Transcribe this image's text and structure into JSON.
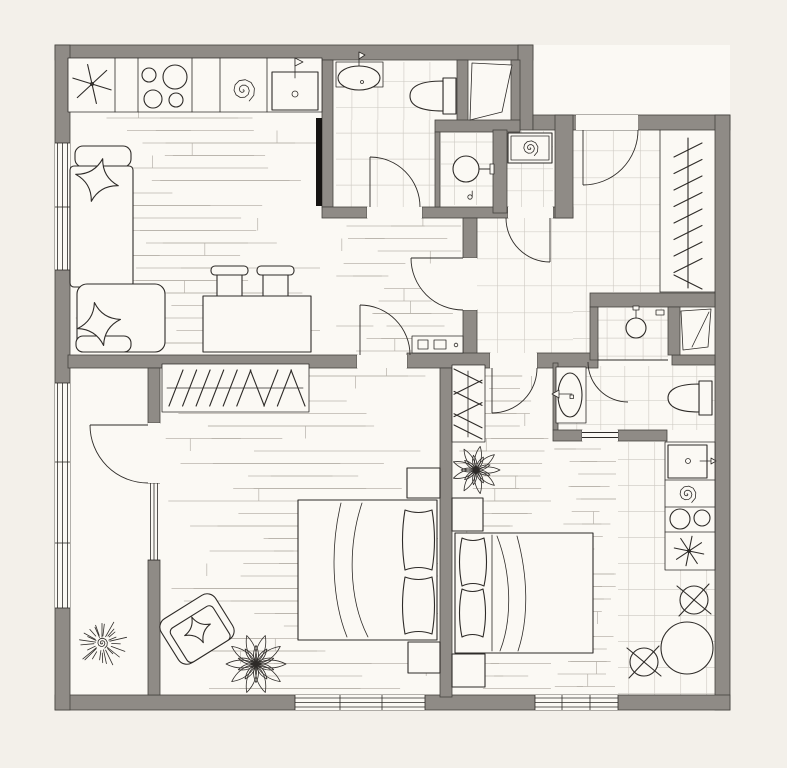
{
  "drawing": {
    "type": "apartment-floor-plan",
    "style": "hand-drawn architectural top view, no text labels"
  },
  "colors": {
    "bg": "#f3f0ea",
    "floor": "#fbf9f4",
    "wall": "#8f8b86",
    "wallEdge": "#44413e",
    "line": "#2e2b28",
    "tile": "#cdc9c2",
    "plank": "#b4afa7",
    "black": "#161412"
  },
  "rooms": [
    {
      "name": "living-room-with-kitchen",
      "fixtures": [
        "kitchen-counter",
        "extractor-star",
        "cooktop-4-burners",
        "spiral-appliance",
        "kitchen-sink-with-tap",
        "tall-black-unit",
        "corner-sofa",
        "two-star-pillows",
        "dining-table",
        "two-stools",
        "low-console"
      ]
    },
    {
      "name": "bathroom-top",
      "fixtures": [
        "vanity-sink",
        "toilet",
        "swing-door"
      ]
    },
    {
      "name": "water-closet",
      "fixtures": [
        "wall-basin-with-rail"
      ]
    },
    {
      "name": "utility-closet",
      "fixtures": [
        "washing-machine",
        "swing-door"
      ]
    },
    {
      "name": "entry-hall",
      "fixtures": [
        "entrance-door",
        "open-wardrobe-with-hangers",
        "tiled-floor"
      ]
    },
    {
      "name": "built-in-closet-top",
      "fixtures": [
        "trapezoid-wardrobe"
      ]
    },
    {
      "name": "shower-room",
      "fixtures": [
        "shower-head",
        "soap-shelf",
        "swing-door"
      ]
    },
    {
      "name": "built-in-closet-middle",
      "fixtures": [
        "trapezoid-wardrobe"
      ]
    },
    {
      "name": "bathroom-bottom",
      "fixtures": [
        "vanity-sink",
        "toilet",
        "doorway"
      ]
    },
    {
      "name": "bedroom",
      "fixtures": [
        "wardrobe-with-hangers",
        "double-bed",
        "two-pillows",
        "two-nightstands",
        "armchair-with-pillow",
        "plant"
      ]
    },
    {
      "name": "studio-room",
      "fixtures": [
        "wardrobe-with-hangers",
        "plant",
        "double-bed",
        "two-pillows",
        "two-nightstands",
        "kitchenette-counter",
        "sink-with-tap",
        "spiral-appliance",
        "cooktop-2-burners",
        "extractor-star",
        "round-table",
        "two-chairs"
      ]
    },
    {
      "name": "balcony",
      "fixtures": [
        "spiky-plant",
        "glazed-wall",
        "balcony-door"
      ]
    }
  ]
}
